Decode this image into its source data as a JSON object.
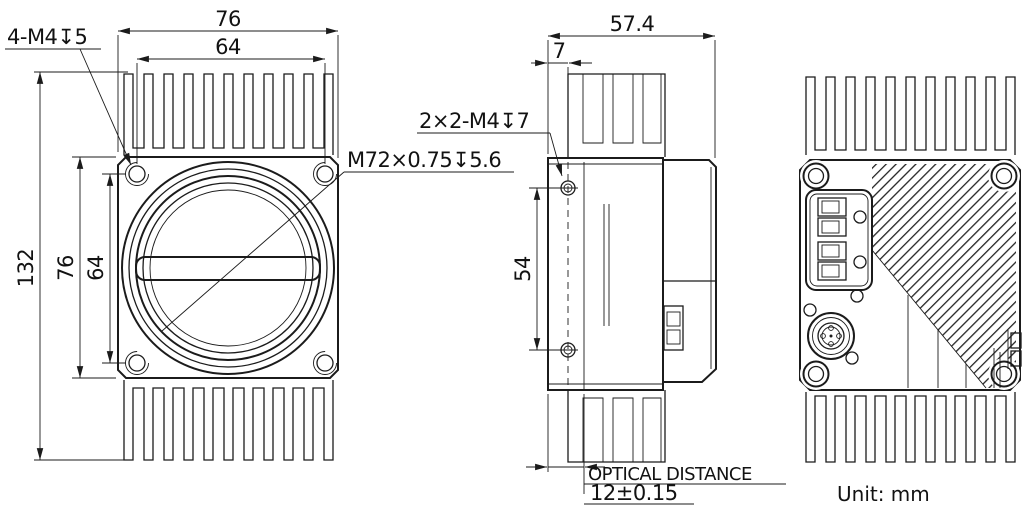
{
  "drawing": {
    "unit_note": "Unit: mm",
    "front": {
      "callout_mount_holes": "4-M4↧5",
      "callout_lens_thread": "M72×0.75↧5.6",
      "dim_width_overall": "76",
      "dim_width_holes": "64",
      "dim_height_overall": "132",
      "dim_height_body": "76",
      "dim_height_holes": "64"
    },
    "side": {
      "callout_side_holes": "2×2-M4↧7",
      "dim_depth_overall": "57.4",
      "dim_front_to_holes": "7",
      "dim_hole_spacing": "54",
      "optical_label": "OPTICAL DISTANCE",
      "optical_value": "12±0.15"
    }
  }
}
